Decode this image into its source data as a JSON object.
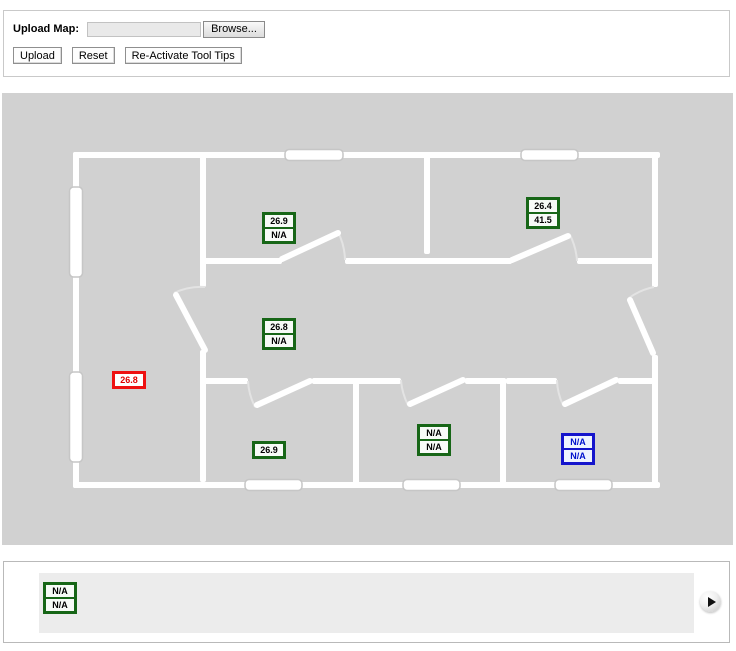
{
  "upload_panel": {
    "label": "Upload Map:",
    "file_input_value": "",
    "browse_label": "Browse...",
    "upload_label": "Upload",
    "reset_label": "Reset",
    "reactivate_label": "Re-Activate Tool Tips"
  },
  "map": {
    "background_color": "#d1d1d1",
    "wall_color": "#ffffff",
    "sensor_colors": {
      "green": "#176617",
      "red": "#ee1111",
      "blue": "#1414cc"
    },
    "sensors": [
      {
        "id": "sensor-top-middle-room",
        "color": "green",
        "values": [
          "26.9",
          "N/A"
        ],
        "x": 260,
        "y": 119
      },
      {
        "id": "sensor-top-right-room",
        "color": "green",
        "values": [
          "26.4",
          "41.5"
        ],
        "x": 524,
        "y": 104
      },
      {
        "id": "sensor-hall",
        "color": "green",
        "values": [
          "26.8",
          "N/A"
        ],
        "x": 260,
        "y": 225
      },
      {
        "id": "sensor-left-room",
        "color": "red",
        "values": [
          "26.8"
        ],
        "x": 110,
        "y": 278
      },
      {
        "id": "sensor-bottom-left-room",
        "color": "green",
        "values": [
          "26.9"
        ],
        "x": 250,
        "y": 348
      },
      {
        "id": "sensor-bottom-mid-room",
        "color": "green",
        "values": [
          "N/A",
          "N/A"
        ],
        "x": 415,
        "y": 331
      },
      {
        "id": "sensor-bottom-right-room",
        "color": "blue",
        "values": [
          "N/A",
          "N/A"
        ],
        "x": 559,
        "y": 340
      }
    ]
  },
  "carousel": {
    "strip_color": "#ececec",
    "unplaced_sensor": {
      "id": "sensor-unplaced",
      "color": "green",
      "values": [
        "N/A",
        "N/A"
      ]
    },
    "next_icon": "play-icon"
  }
}
